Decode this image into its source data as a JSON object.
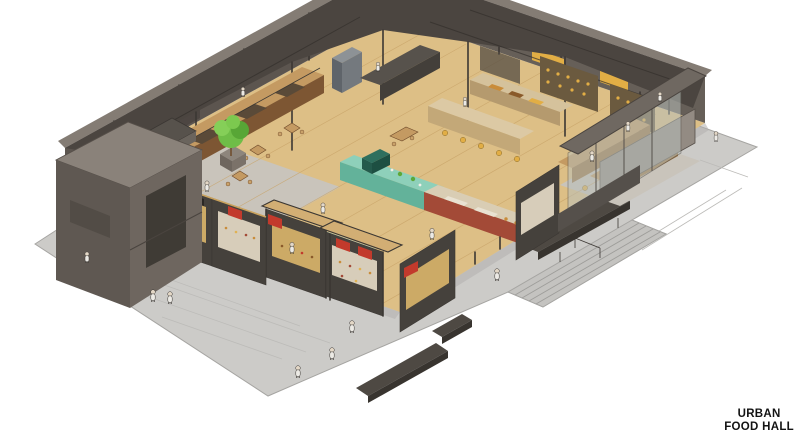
{
  "title": {
    "line1": "URBAN",
    "line2": "FOOD HALL"
  },
  "illustration": {
    "type": "isometric architectural cutaway sketch",
    "description": "Bird's-eye axonometric illustration of an urban food hall: dark-walled industrial shell cut open to show a wood-floored market interior with food stalls, display counters, canopy-frame kiosks, cafe seating, a tree planter and visitors; a concrete plaza with wide entry stairs, benches and a glazed entrance vestibule surrounds the building.",
    "elements": [
      "plaza",
      "entry-stairs",
      "benches",
      "wood-floor",
      "back-walls",
      "roof-cutaway",
      "mezzanine-block",
      "food-stalls",
      "teal-counters",
      "maroon-counter",
      "canopy-stalls",
      "storefront-row",
      "entrance-vestibule",
      "tree",
      "people"
    ]
  },
  "palette": {
    "background": "#ffffff",
    "plaza": "#cccbc8",
    "plaza_edge": "#a6a5a2",
    "plaza_joint": "#bcbbb8",
    "plaza_shadow": "#b2b1ae",
    "floor_wood": "#ddbf86",
    "floor_plank": "#c8a368",
    "floor_concrete": "#c9c4bb",
    "wall_dark": "#5c554f",
    "wall_mid": "#665f58",
    "wall_light": "#847c74",
    "roof_dark": "#4b4540",
    "counter_teal": "#8ed0ba",
    "counter_teal_dark": "#63b29a",
    "counter_maroon": "#a34a37",
    "counter_wood": "#c49a62",
    "counter_wood_dark": "#9c7444",
    "counter_dark": "#57524c",
    "canopy_wood": "#d2ae74",
    "storefront_dark": "#45413c",
    "window_lit": "#d8b36a",
    "window_display": "#e7ddc8",
    "accent_yellow": "#e2ae45",
    "accent_red": "#c23a2c",
    "tree_green": "#6fbd47",
    "bench_dark": "#4e4943",
    "figure": "#eceae5",
    "figure_head": "#e3d7c6",
    "ink": "#3b3733",
    "text": "#131313"
  }
}
